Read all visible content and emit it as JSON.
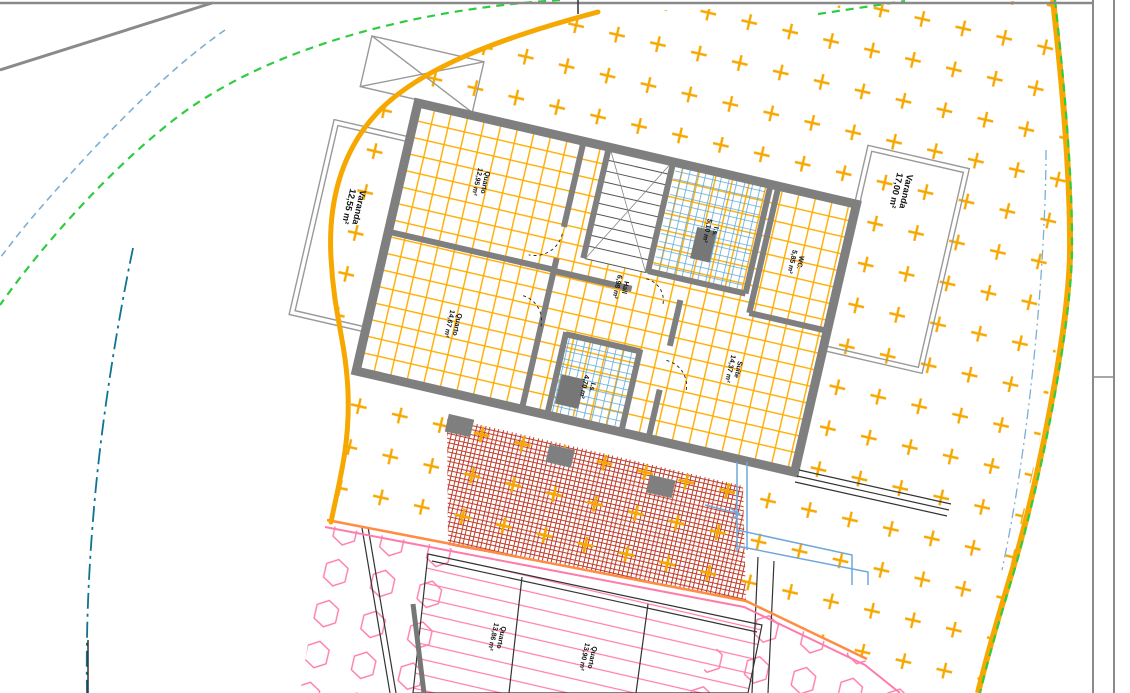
{
  "drawing": {
    "type": "architectural-floor-plan",
    "rooms": {
      "varanda_left": {
        "name": "Varanda",
        "area": "12,55 m²"
      },
      "quarto1": {
        "name": "Quarto",
        "area": "12,95 m²"
      },
      "quarto2": {
        "name": "Quarto",
        "area": "14,67 m²"
      },
      "hall": {
        "name": "Hall",
        "area": "6,98 m²"
      },
      "is_top": {
        "name": "I.s.",
        "area": "5,10 m²"
      },
      "wc": {
        "name": "WC.",
        "area": "5,85 m²"
      },
      "suite": {
        "name": "Suite",
        "area": "14,37 m²"
      },
      "is_low": {
        "name": "I.s.",
        "area": "4,70 m²"
      },
      "varanda_right": {
        "name": "Varanda",
        "area": "17,00 m²"
      },
      "quarto_b1": {
        "name": "Quarto",
        "area": "13,86 m²"
      },
      "quarto_b2": {
        "name": "Quarto",
        "area": "13,90 m²"
      }
    },
    "colors": {
      "lot_boundary": "#F7A800",
      "cross_hatch": "#F7A800",
      "floor_grid": "#FFAD00",
      "wall_gray": "#7F7F7F",
      "tile_blue": "#5FA8D3",
      "brick_red": "#C13B2A",
      "pink_hatch": "#FF7BAC",
      "salmon_line": "#FF8C42",
      "green_boundary": "#2ECC40",
      "teal_line": "#0E7490",
      "blue_dashed": "#7BAFD4",
      "frame_gray": "#8A8A8A"
    }
  }
}
